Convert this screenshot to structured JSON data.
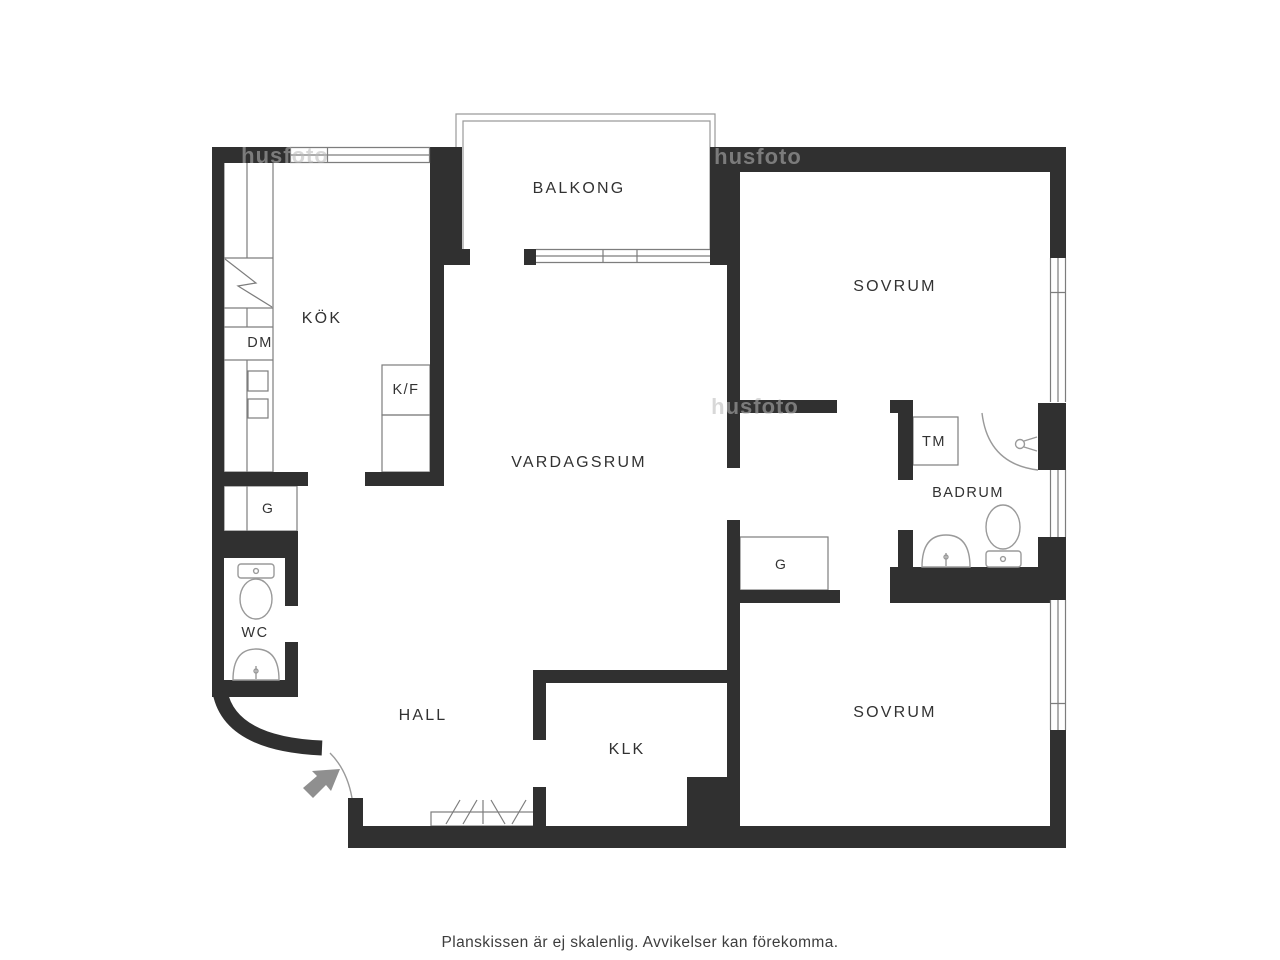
{
  "page": {
    "footer_note": "Planskissen är ej skalenlig. Avvikelser kan förekomma.",
    "watermark_text": "husfoto"
  },
  "colors": {
    "background": "#ffffff",
    "wall": "#303030",
    "thin_line": "#7d7d7d",
    "fixture_line": "#9a9a9a",
    "label_text": "#323232",
    "footer_text": "#3d3d3d",
    "arrow": "#8f8f8f",
    "watermark": "#b9b9b9"
  },
  "rooms": {
    "balkong": {
      "label": "BALKONG"
    },
    "kok": {
      "label": "KÖK"
    },
    "sovrum_top": {
      "label": "SOVRUM"
    },
    "vardagsrum": {
      "label": "VARDAGSRUM"
    },
    "badrum": {
      "label": "BADRUM"
    },
    "wc": {
      "label": "WC"
    },
    "hall": {
      "label": "HALL"
    },
    "klk": {
      "label": "KLK"
    },
    "sovrum_bottom": {
      "label": "SOVRUM"
    }
  },
  "fixtures": {
    "dm": {
      "label": "DM"
    },
    "kf": {
      "label": "K/F"
    },
    "tm": {
      "label": "TM"
    },
    "g_hall": {
      "label": "G"
    },
    "g_bedroom": {
      "label": "G"
    }
  }
}
